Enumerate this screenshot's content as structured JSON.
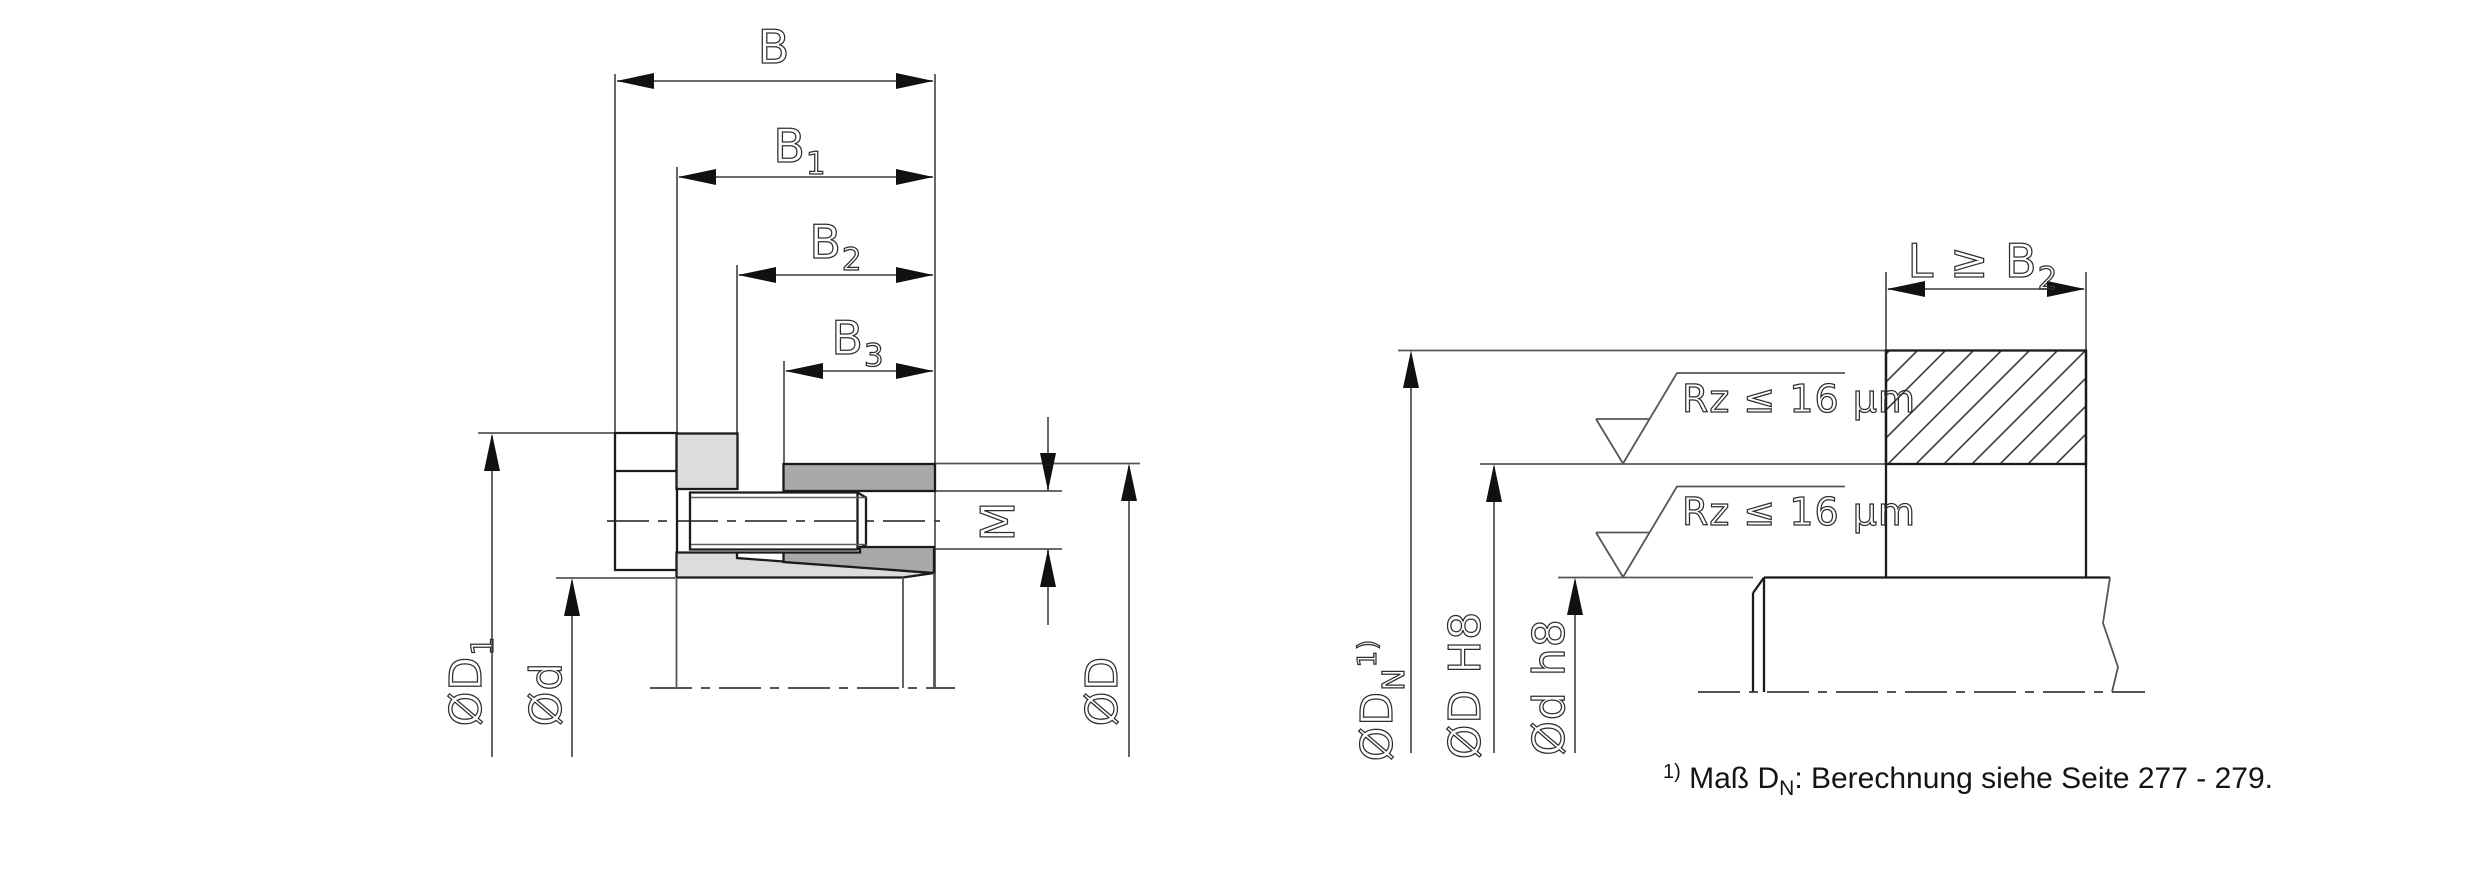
{
  "drawing": {
    "left_figure": {
      "dim_b": "B",
      "dim_b1": {
        "base": "B",
        "sub": "1"
      },
      "dim_b2": {
        "base": "B",
        "sub": "2"
      },
      "dim_b3": {
        "base": "B",
        "sub": "3"
      },
      "thread_label": "M",
      "dia_d1": {
        "base": "ØD",
        "sub": "1"
      },
      "dia_d_shaft": "Ød",
      "dia_d_bore": "ØD"
    },
    "right_figure": {
      "dim_l": {
        "base": "L ≥ B",
        "sub": "2"
      },
      "roughness_top": "Rz ≤ 16 µm",
      "roughness_bottom": "Rz ≤ 16 µm",
      "dia_dn": {
        "base": "ØD",
        "sub": "N",
        "sup": "1)"
      },
      "dia_d_h8": "ØD H8",
      "dia_d_h8_small": "Ød h8"
    },
    "footnote": {
      "sup": "1)",
      "part1": " Maß D",
      "sub": "N",
      "part2": ": Berechnung siehe Seite 277 - 279."
    },
    "colors": {
      "light_gray": "#dcdcdc",
      "dark_gray": "#a9a9a9",
      "outline": "#1b1b1b",
      "dim_line": "#565656",
      "arrow": "#111111",
      "background": "#ffffff"
    }
  }
}
